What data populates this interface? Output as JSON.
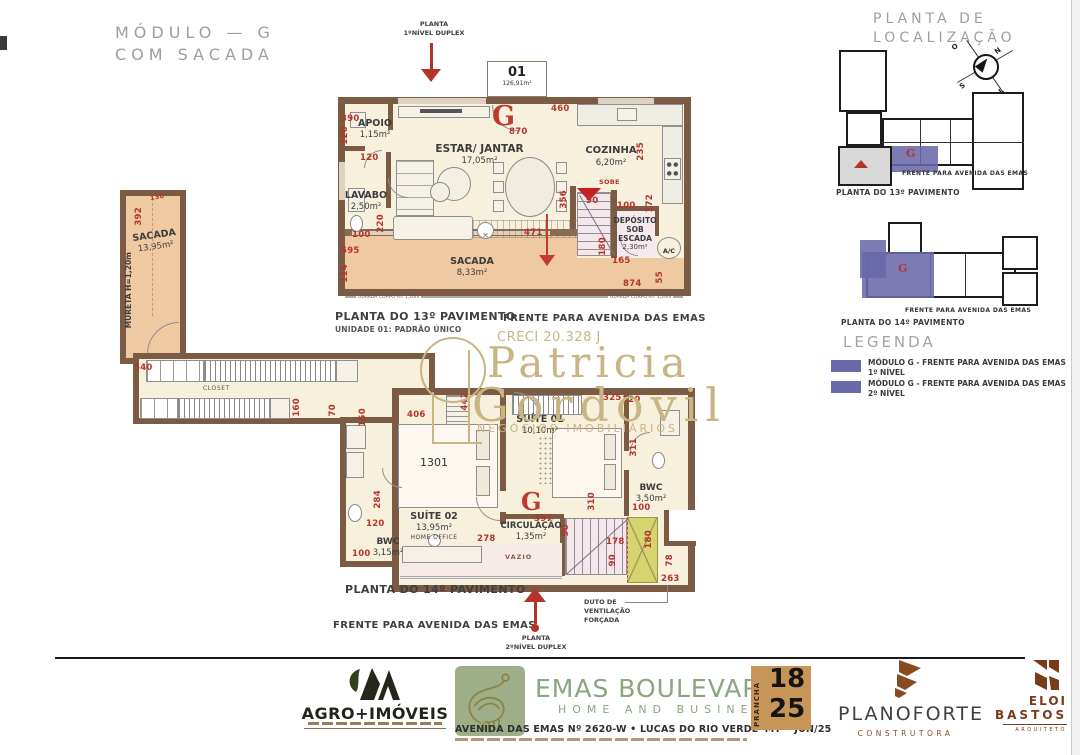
{
  "page": {
    "title1": "MÓDULO — G",
    "title2": "COM SACADA"
  },
  "plan1": {
    "arrow1": "PLANTA",
    "arrow2": "1ºNÍVEL DUPLEX",
    "unit": {
      "number": "01",
      "area": "126,91m²"
    },
    "g": "G",
    "rooms": {
      "apoio": {
        "name": "APOIO",
        "area": "1,15m²"
      },
      "estar": {
        "name": "ESTAR/ JANTAR",
        "area": "17,05m²"
      },
      "cozinha": {
        "name": "COZINHA",
        "area": "6,20m²"
      },
      "lavabo": {
        "name": "LAVABO",
        "area": "2,50m²"
      },
      "sacada": {
        "name": "SACADA",
        "area": "8,33m²"
      },
      "sacada_lateral": {
        "name": "SACADA",
        "area": "13,95m²"
      },
      "deposito": {
        "l1": "DEPÓSITO",
        "l2": "SOB",
        "l3": "ESCADA",
        "area": "2,30m²"
      },
      "ac": "A/C",
      "sobe": "SOBE",
      "mureta": "MURETA H=1,20m"
    },
    "guarda_corpo": "GUARDA CORPO H= 1,20m",
    "dims": [
      "390",
      "120",
      "120",
      "100",
      "220",
      "595",
      "114",
      "870",
      "460",
      "235",
      "356",
      "90",
      "100",
      "172",
      "180",
      "165",
      "471",
      "874",
      "55",
      "392",
      "130"
    ],
    "captions": {
      "line1": "PLANTA DO 13º PAVIMENTO",
      "line2": "UNIDADE 01: PADRÃO ÚNICO",
      "front": "FRENTE PARA AVENIDA DAS EMAS"
    }
  },
  "watermark": {
    "creci": "CRECI 20.328 J",
    "name1": "Patricia",
    "name2": "Gordovil",
    "tagline": "NEGÓCIOS IMOBILIÁRIOS"
  },
  "plan2": {
    "g": "G",
    "rooms": {
      "closet": "CLOSET",
      "unit": "1301",
      "suite02": {
        "name": "SUÍTE 02",
        "area": "13,95m²",
        "extra": "HOME OFFICE"
      },
      "bwc2": {
        "name": "BWC",
        "area": "3,15m²"
      },
      "suite01": {
        "name": "SUÍTE 01",
        "area": "10,10m²"
      },
      "circulacao": {
        "name": "CIRCULAÇÃO",
        "area": "1,35m²"
      },
      "bwc1": {
        "name": "BWC",
        "area": "3,50m²"
      },
      "vazio": "VAZIO"
    },
    "dims": [
      "540",
      "160",
      "70",
      "150",
      "406",
      "442",
      "325",
      "120",
      "311",
      "310",
      "100",
      "284",
      "120",
      "100",
      "278",
      "397",
      "90",
      "178",
      "180",
      "90",
      "78",
      "263"
    ],
    "captions": {
      "line1": "PLANTA DO 14º PAVIMENTO",
      "front": "FRENTE PARA AVENIDA DAS EMAS",
      "arrow1": "PLANTA",
      "arrow2": "2ºNÍVEL DUPLEX",
      "duct1": "DUTO DE",
      "duct2": "VENTILAÇÃO",
      "duct3": "FORÇADA"
    }
  },
  "location": {
    "title": "PLANTA DE LOCALIZAÇÃO",
    "compass": {
      "o": "O",
      "n": "N",
      "s": "S",
      "l": "L"
    },
    "b13": {
      "g": "G",
      "front": "FRENTE PARA AVENIDA DAS EMAS",
      "caption": "PLANTA DO 13º PAVIMENTO"
    },
    "b14": {
      "g": "G",
      "front": "FRENTE PARA AVENIDA DAS EMAS",
      "caption": "PLANTA DO 14º PAVIMENTO"
    },
    "legend": {
      "title": "LEGENDA",
      "item1": {
        "label": "MÓDULO G - FRENTE PARA AVENIDA DAS EMAS",
        "level": "1º NÍVEL"
      },
      "item2": {
        "label": "MÓDULO G - FRENTE PARA AVENIDA DAS EMAS",
        "level": "2º NÍVEL"
      }
    }
  },
  "footer": {
    "agro": {
      "name": "AGRO+IMÓVEIS"
    },
    "emas": {
      "name": "EMAS BOULEVARD",
      "sub": "HOME AND BUSINESS",
      "address": "AVENIDA DAS EMAS Nº 2620-W • LUCAS DO RIO VERDE•MT • JUN/25"
    },
    "prancha": {
      "label": "PRANCHA",
      "num": "18",
      "den": "25"
    },
    "planoforte": {
      "name": "PLANOFORTE",
      "sub": "CONSTRUTORA"
    },
    "eloi": {
      "l1": "ELOI",
      "l2": "BASTOS",
      "l3": "ARQUITETO"
    }
  },
  "colors": {
    "dim_red": "#b5342a",
    "wall": "#7b5b43",
    "balcony": "#eec9a1",
    "floor": "#f7f0dd",
    "purple": "#6a69a9",
    "gold": "#c9b584",
    "green": "#8ba57e"
  }
}
